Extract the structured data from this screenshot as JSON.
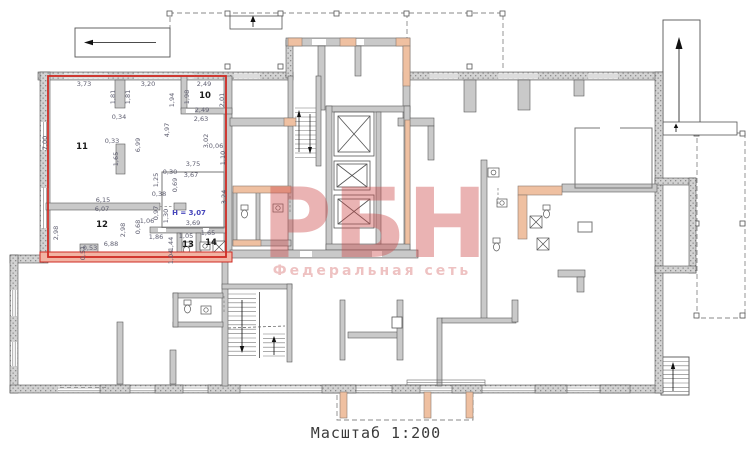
{
  "caption": {
    "scale_label": "Масштаб 1:200"
  },
  "watermark": {
    "title": "РБН",
    "subtitle": "Федеральная сеть"
  },
  "colors": {
    "unit_outline": "#cf2b24",
    "wall_fill": "#c9c9c9",
    "accent_wall": "#efc0a1",
    "watermark": "#cd4b4b",
    "dim_text": "#5e5e70",
    "height_text": "#4545bb"
  },
  "rooms": [
    {
      "number": "10",
      "x": 205,
      "y": 96
    },
    {
      "number": "11",
      "x": 82,
      "y": 147
    },
    {
      "number": "12",
      "x": 102,
      "y": 225
    },
    {
      "number": "13",
      "x": 188,
      "y": 245
    },
    {
      "number": "14",
      "x": 211,
      "y": 243
    }
  ],
  "height_label": {
    "text": "Н = 3,07",
    "x": 189,
    "y": 213
  },
  "dim_labels": [
    {
      "t": "3,73",
      "x": 84,
      "y": 84
    },
    {
      "t": "3,20",
      "x": 148,
      "y": 84
    },
    {
      "t": "2,49",
      "x": 204,
      "y": 84
    },
    {
      "t": "1,81",
      "x": 113,
      "y": 97,
      "r": 1
    },
    {
      "t": "1,81",
      "x": 128,
      "y": 97,
      "r": 1
    },
    {
      "t": "1,94",
      "x": 172,
      "y": 100,
      "r": 1
    },
    {
      "t": "1,98",
      "x": 187,
      "y": 97,
      "r": 1
    },
    {
      "t": "2,01",
      "x": 222,
      "y": 100,
      "r": 1
    },
    {
      "t": "0,34",
      "x": 119,
      "y": 117
    },
    {
      "t": "2,49",
      "x": 202,
      "y": 110
    },
    {
      "t": "2,63",
      "x": 201,
      "y": 119
    },
    {
      "t": "4,97",
      "x": 167,
      "y": 130,
      "r": 1
    },
    {
      "t": "6,99",
      "x": 138,
      "y": 145,
      "r": 1
    },
    {
      "t": "7,00",
      "x": 45,
      "y": 143,
      "r": 1
    },
    {
      "t": "0,33",
      "x": 112,
      "y": 141
    },
    {
      "t": "1,65",
      "x": 116,
      "y": 159,
      "r": 1
    },
    {
      "t": "3,02",
      "x": 206,
      "y": 141,
      "r": 1
    },
    {
      "t": "0,06",
      "x": 216,
      "y": 146
    },
    {
      "t": "1,10",
      "x": 223,
      "y": 158,
      "r": 1
    },
    {
      "t": "3,75",
      "x": 193,
      "y": 164
    },
    {
      "t": "3,67",
      "x": 191,
      "y": 175
    },
    {
      "t": "1,25",
      "x": 156,
      "y": 180,
      "r": 1
    },
    {
      "t": "0,30",
      "x": 170,
      "y": 172
    },
    {
      "t": "0,69",
      "x": 175,
      "y": 185,
      "r": 1
    },
    {
      "t": "0,38",
      "x": 159,
      "y": 194
    },
    {
      "t": "6,15",
      "x": 103,
      "y": 200
    },
    {
      "t": "6,07",
      "x": 102,
      "y": 209
    },
    {
      "t": "2,98",
      "x": 56,
      "y": 233,
      "r": 1
    },
    {
      "t": "2,98",
      "x": 123,
      "y": 230,
      "r": 1
    },
    {
      "t": "0,97",
      "x": 156,
      "y": 213,
      "r": 1
    },
    {
      "t": "1,30",
      "x": 166,
      "y": 216,
      "r": 1
    },
    {
      "t": "1,06",
      "x": 147,
      "y": 221
    },
    {
      "t": "3,69",
      "x": 193,
      "y": 223
    },
    {
      "t": "0,68",
      "x": 138,
      "y": 227,
      "r": 1
    },
    {
      "t": "1,86",
      "x": 156,
      "y": 237
    },
    {
      "t": "1,05",
      "x": 186,
      "y": 236
    },
    {
      "t": "1,65",
      "x": 208,
      "y": 233
    },
    {
      "t": "6,88",
      "x": 111,
      "y": 244
    },
    {
      "t": "0,53",
      "x": 90,
      "y": 248
    },
    {
      "t": "0,51",
      "x": 83,
      "y": 253,
      "r": 1
    },
    {
      "t": "1,44",
      "x": 171,
      "y": 244,
      "r": 1
    },
    {
      "t": "1,04",
      "x": 171,
      "y": 257,
      "r": 1
    },
    {
      "t": "3,24",
      "x": 224,
      "y": 197,
      "r": 1
    }
  ]
}
